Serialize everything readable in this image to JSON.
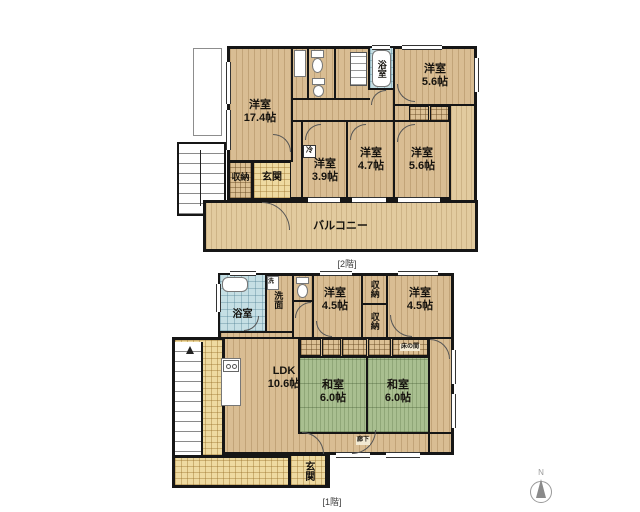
{
  "floors": {
    "f2": {
      "caption": "[2階]",
      "rooms": {
        "western_17_4": {
          "name": "洋室",
          "size": "17.4帖"
        },
        "bath": {
          "name": "浴室"
        },
        "western_5_6_top": {
          "name": "洋室",
          "size": "5.6帖"
        },
        "western_3_9": {
          "name": "洋室",
          "size": "3.9帖"
        },
        "western_4_7": {
          "name": "洋室",
          "size": "4.7帖"
        },
        "western_5_6_right": {
          "name": "洋室",
          "size": "5.6帖"
        },
        "storage": {
          "name": "収納"
        },
        "entrance": {
          "name": "玄関"
        },
        "balcony": {
          "name": "バルコニー"
        },
        "fridge": {
          "name": "冷"
        }
      }
    },
    "f1": {
      "caption": "[1階]",
      "rooms": {
        "bath": {
          "name": "浴室"
        },
        "laundry": {
          "name": "洗"
        },
        "washroom": {
          "name": "洗面"
        },
        "western_4_5_left": {
          "name": "洋室",
          "size": "4.5帖"
        },
        "storage_top": {
          "name": "収納"
        },
        "storage_bottom": {
          "name": "収納"
        },
        "western_4_5_right": {
          "name": "洋室",
          "size": "4.5帖"
        },
        "tokonoma": {
          "name": "床の間"
        },
        "japanese_left": {
          "name": "和室",
          "size": "6.0帖"
        },
        "japanese_right": {
          "name": "和室",
          "size": "6.0帖"
        },
        "ldk": {
          "name": "LDK",
          "size": "10.6帖"
        },
        "hallway": {
          "name": "廊下"
        },
        "entrance": {
          "name": "玄関"
        }
      }
    }
  },
  "compass": {
    "label": "N"
  },
  "colors": {
    "wood": "#d9bd93",
    "balcony": "#e2cb9f",
    "tatami": "#a9bf90",
    "tile": "#eedaa1",
    "bath_tile": "#c5dfe4",
    "wall": "#161616"
  }
}
